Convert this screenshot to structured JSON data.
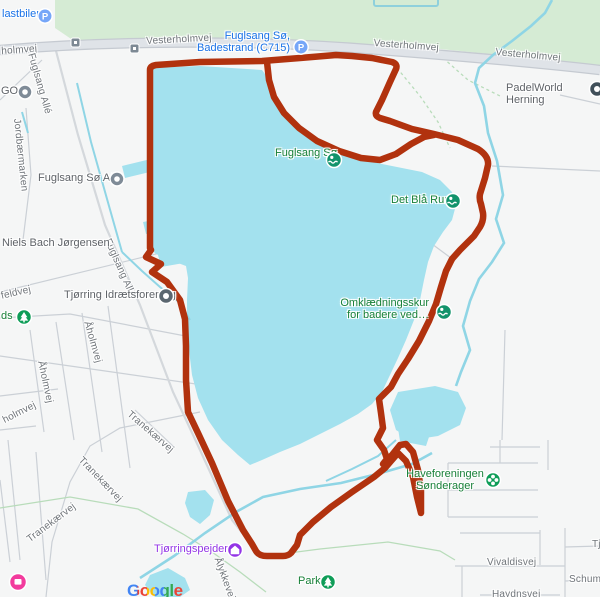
{
  "attribution": {
    "logo": "Google"
  },
  "colors": {
    "route": "#b1320e",
    "water": "#a3e1ee",
    "stream": "#8fd5e5",
    "park_green": "#d5ebd4",
    "road_fill": "#dfe3e8",
    "poi_green": "#188038",
    "poi_blue": "#1a73e8",
    "poi_purple": "#9334e6",
    "poi_gray": "#5f6368"
  },
  "icons": {
    "parking_glyph": "P"
  },
  "streets": {
    "vesterholmvej_w": "holmvej",
    "vesterholmvej_1": "Vesterholmvej",
    "vesterholmvej_2": "Vesterholmvej",
    "vesterholmvej_3": "Vesterholmvej",
    "fuglsang_alle_1": "Fuglsang Allé",
    "fuglsang_alle_2": "Fuglsang Allé",
    "jordbaermarken": "Jordbærmarken",
    "feldvej": "feldvej",
    "aaholmvej_1": "Åholmvej",
    "aaholmvej_2": "Åholmvej",
    "aaholmvej_3": "holmvej",
    "tranekaervej_1": "Tranekærvej",
    "tranekaervej_2": "Tranekærvej",
    "tranekaervej_3": "Tranekærvej",
    "aalykkevej": "Ålykkevej",
    "vivaldisvej": "Vivaldisvej",
    "schumannsvej_partial": "Schuman",
    "tj_partial": "Tj",
    "haydnsvej": "Haydnsvej"
  },
  "pois": {
    "lastbiler": {
      "label": "lastbiler"
    },
    "badestrand": {
      "label": "Fuglsang Sø,\nBadestrand (C715)"
    },
    "padelworld": {
      "label": "PadelWorld Herning"
    },
    "gos": {
      "label": "GOS"
    },
    "fuglsang_as": {
      "label": "Fuglsang Sø A/S"
    },
    "niels_bach": {
      "label": "Niels Bach Jørgensen"
    },
    "tjoerring_if": {
      "label": "Tjørring Idrætsforening"
    },
    "plads": {
      "label": "ds"
    },
    "fuglsang_soe": {
      "label": "Fuglsang Sø"
    },
    "det_blaa_rum": {
      "label": "Det Blå Rum"
    },
    "omklaedningsskur": {
      "label": "Omklædningsskur\nfor badere ved…"
    },
    "haveforeningen": {
      "label": "Haveforeningen\nSønderager"
    },
    "tjoerringspejderne": {
      "label": "Tjørringspejderne"
    },
    "park": {
      "label": "Park"
    }
  }
}
